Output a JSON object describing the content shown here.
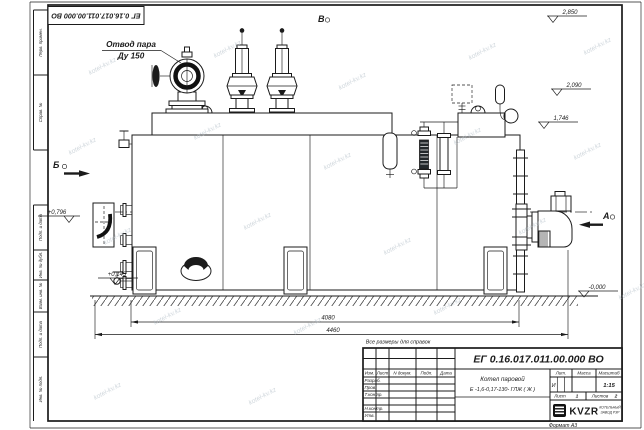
{
  "meta": {
    "watermark": "kotel-kv.kz"
  },
  "frame": {
    "doc_number_top": "ЕГ 0.16.017.011.00.000  ВО",
    "side_columns": [
      "Перв. примен.",
      "Справ. №",
      "Подп. и дата",
      "Инв. № дубл.",
      "Взам. инв. №",
      "Подп. и дата",
      "Инв. № подл."
    ]
  },
  "drawing": {
    "labels": {
      "steam_outlet_line1": "Отвод пара",
      "steam_outlet_line2": "Ду 150",
      "view_a": "А",
      "view_b": "Б",
      "view_v": "В"
    },
    "elevations": [
      "2,850",
      "2,090",
      "1,746",
      "+0,796",
      "+0,143",
      "-0,000"
    ],
    "dimensions": [
      "4080",
      "4460"
    ],
    "note": "Все размеры для справок"
  },
  "title_block": {
    "doc_number": "ЕГ 0.16.017.011.00.000  ВО",
    "name_line1": "Котел паровой",
    "name_line2": "Е -1,6-0,17-130- ГЛЖ ( Ж )",
    "header_cells": [
      "Изм.",
      "Лист",
      "N докум.",
      "Подп.",
      "Дата"
    ],
    "rows": [
      "Разраб.",
      "Пров.",
      "Т.контр.",
      "Н.контр.",
      "Утв."
    ],
    "lit_label": "Лит.",
    "lit_value": "И",
    "mass_label": "Масса",
    "scale_label": "Масштаб",
    "scale_value": "1:15",
    "sheet_label": "Лист",
    "sheet_value": "1",
    "sheets_label": "Листов",
    "sheets_value": "2",
    "company_logo": "KVZR",
    "company_line1": "КОТЕЛЬНЫЙ",
    "company_line2": "ЗАВОД РЗР",
    "format": "Формат А3"
  }
}
